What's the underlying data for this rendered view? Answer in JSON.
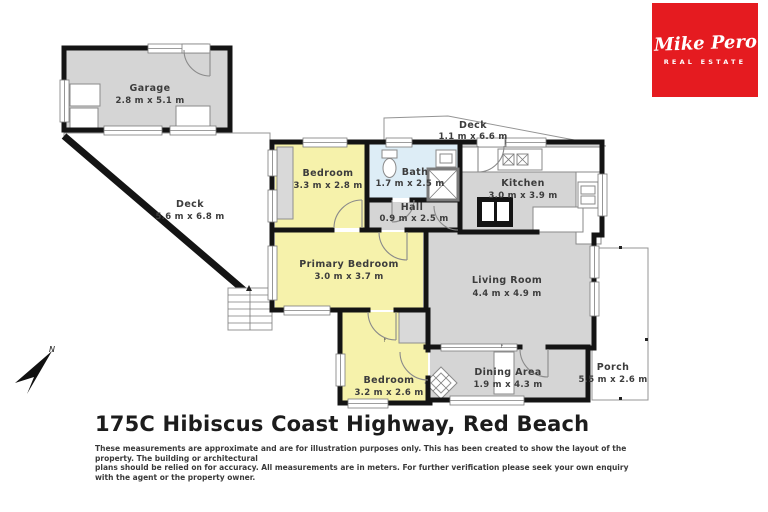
{
  "page": {
    "title": "175C Hibiscus Coast Highway, Red Beach",
    "disclaimer1": "These measurements are approximate and are for illustration purposes only. This has been created to show the layout of the property. The building or architectural",
    "disclaimer2": "plans should be relied on for accuracy. All measurements are in meters. For further verification please seek your own enquiry with the agent or the property owner."
  },
  "logo": {
    "script": "Mike Pero",
    "subtitle": "REAL ESTATE",
    "bg_color": "#e51b20"
  },
  "compass": {
    "label": "N"
  },
  "rooms": {
    "garage": {
      "name": "Garage",
      "dims": "2.8 m x 5.1 m"
    },
    "deck_left": {
      "name": "Deck",
      "dims": "5.6 m x 6.8 m"
    },
    "deck_top": {
      "name": "Deck",
      "dims": "1.1 m x 6.6 m"
    },
    "bedroom_top": {
      "name": "Bedroom",
      "dims": "3.3 m x 2.8 m"
    },
    "bath": {
      "name": "Bath",
      "dims": "1.7 m x 2.5 m"
    },
    "hall": {
      "name": "Hall",
      "dims": "0.9 m x 2.5 m"
    },
    "kitchen": {
      "name": "Kitchen",
      "dims": "3.0 m x 3.9 m"
    },
    "living_room": {
      "name": "Living Room",
      "dims": "4.4 m x 4.9 m"
    },
    "primary_bedroom": {
      "name": "Primary Bedroom",
      "dims": "3.0 m x 3.7 m"
    },
    "bedroom_bottom": {
      "name": "Bedroom",
      "dims": "3.2 m x 2.6 m"
    },
    "dining": {
      "name": "Dining Area",
      "dims": "1.9 m x 4.3 m"
    },
    "porch": {
      "name": "Porch",
      "dims": "5.5 m x 2.6 m"
    }
  },
  "markers": {
    "fireplace_bedroom": "F",
    "fireplace_dining": "F"
  },
  "colors": {
    "floor_gray": "#d5d5d5",
    "room_yellow": "#f6f2ab",
    "bath_blue": "#ddedf6",
    "wall": "#141414",
    "logo_red": "#e51b20"
  }
}
